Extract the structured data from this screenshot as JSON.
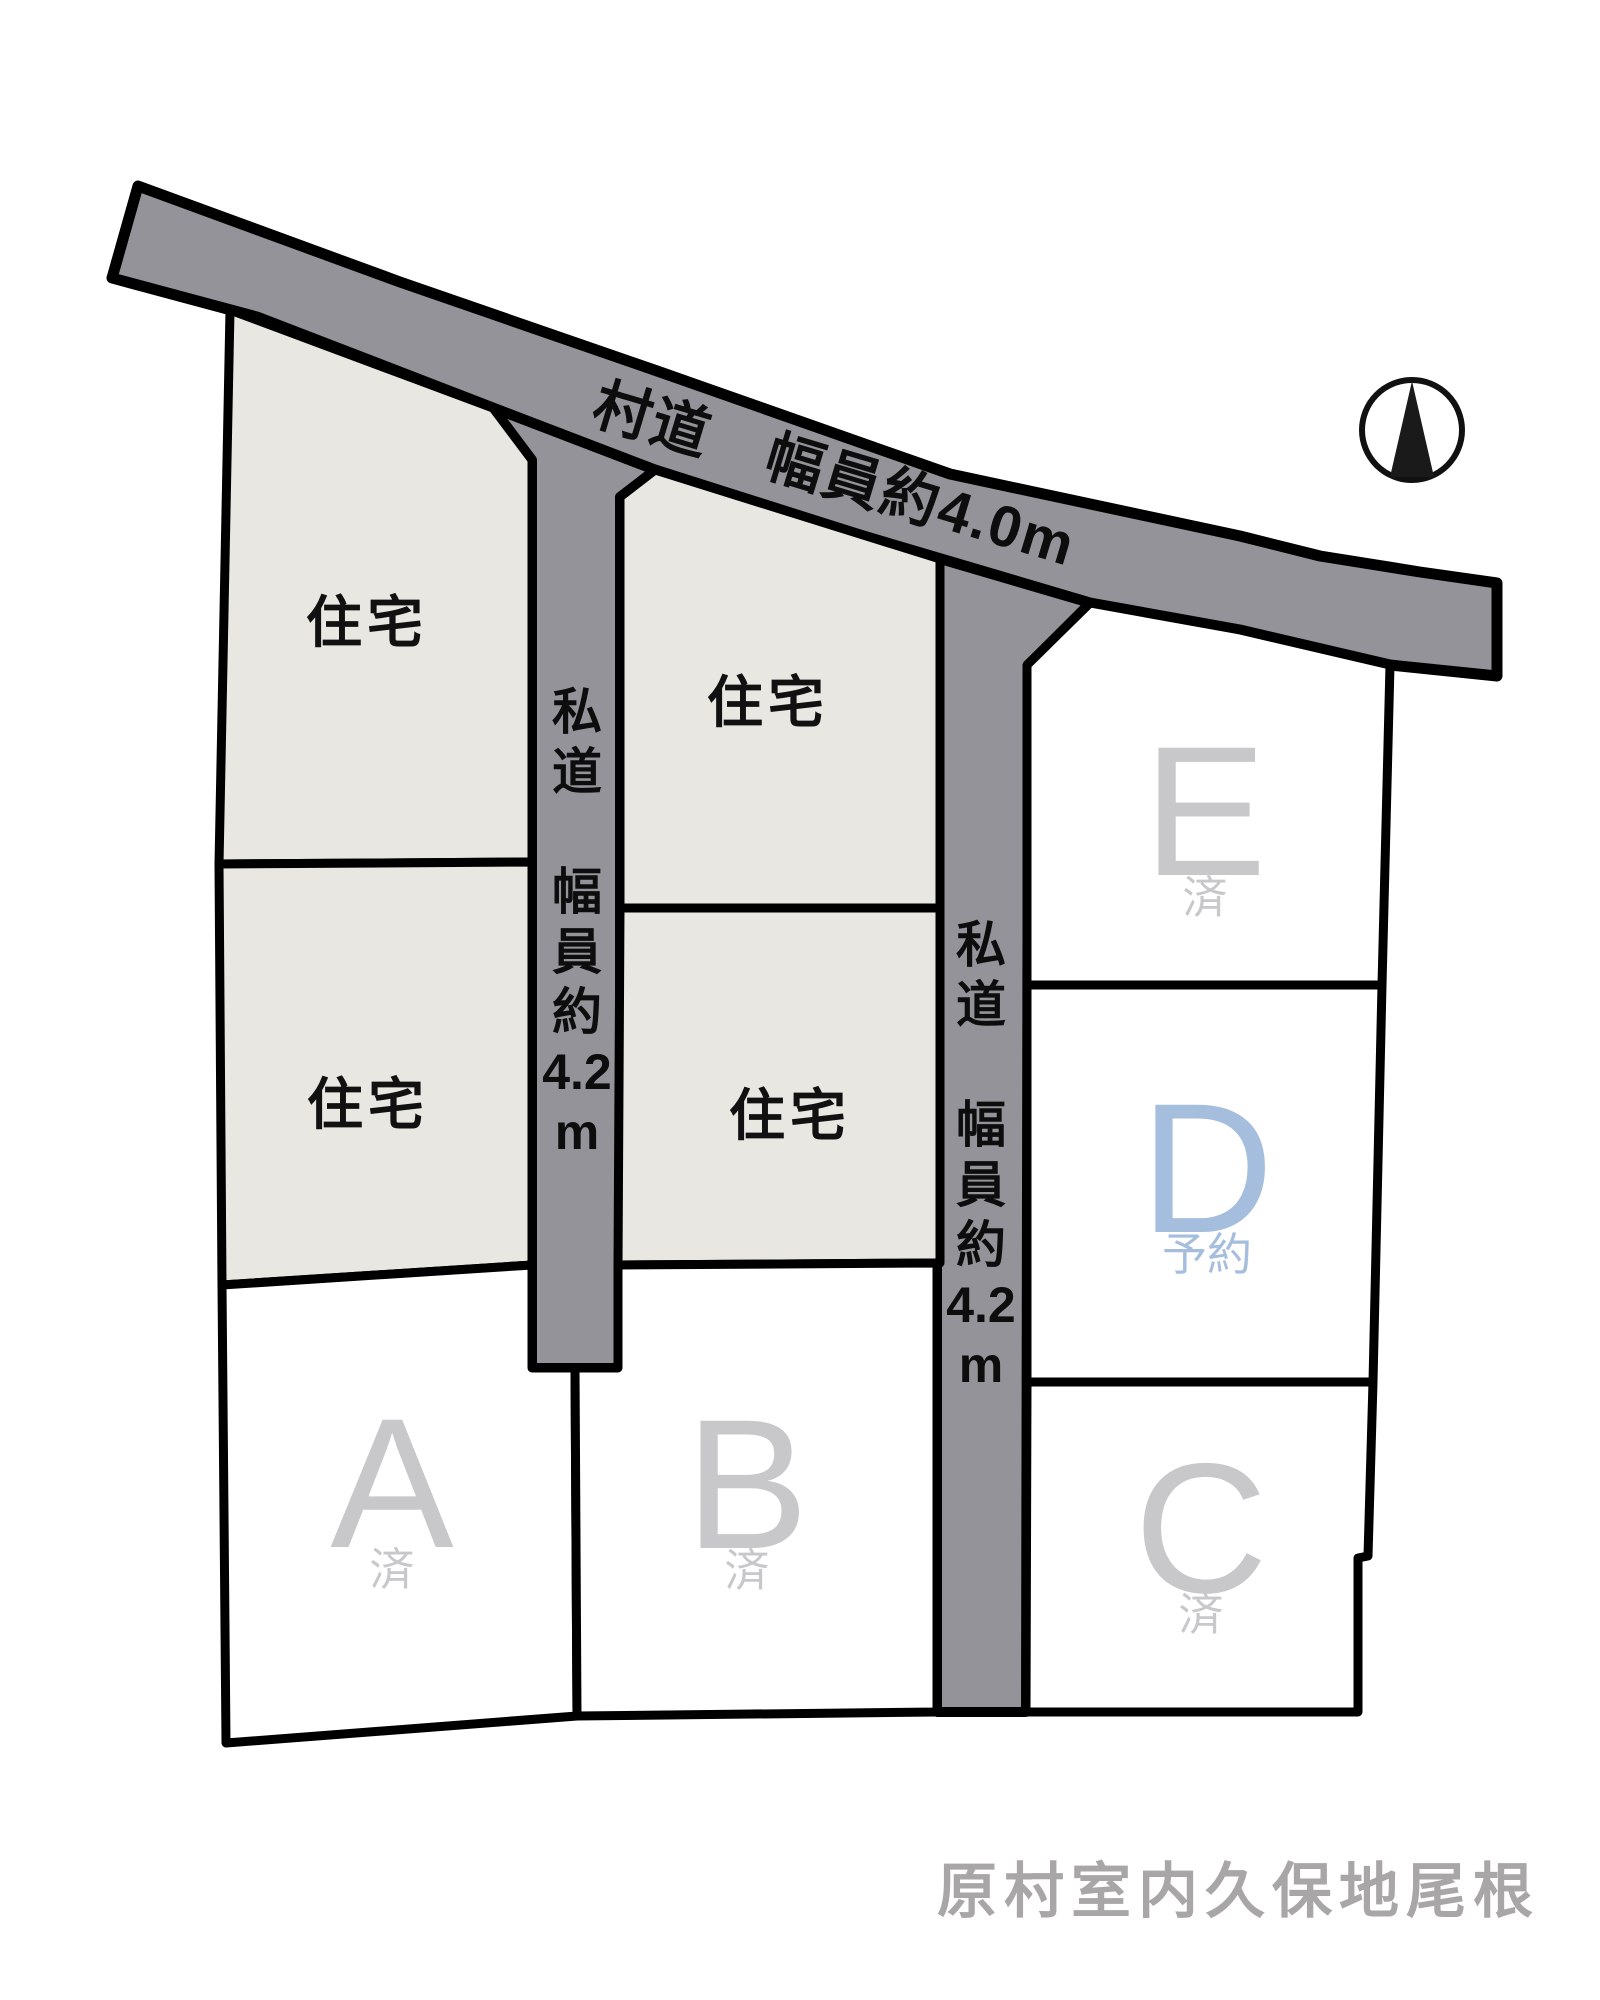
{
  "page": {
    "footer_location": "原村室内久保地尾根"
  },
  "colors": {
    "road_fill": "#949399",
    "residential_fill": "#e9e7e1",
    "plot_fill": "#ffffff",
    "outline": "#000000",
    "sold_text": "#c8c8ca",
    "reserved_text": "#a6bedd",
    "road_text": "#0d0d0d",
    "footer_text": "#a8a6a6"
  },
  "icons": {
    "compass": "north-arrow-icon"
  },
  "roads": {
    "village_road": {
      "label": "村道　幅員約4.0m"
    },
    "private_road_left": {
      "label": "私\n道\n\n幅\n員\n約\n4.2\nm"
    },
    "private_road_right": {
      "label": "私\n道\n\n幅\n員\n約\n4.2\nm"
    }
  },
  "residential_lots": [
    {
      "label": "住宅"
    },
    {
      "label": "住宅"
    },
    {
      "label": "住宅"
    },
    {
      "label": "住宅"
    }
  ],
  "plots": [
    {
      "id": "A",
      "status": "済"
    },
    {
      "id": "B",
      "status": "済"
    },
    {
      "id": "C",
      "status": "済"
    },
    {
      "id": "D",
      "status": "予約"
    },
    {
      "id": "E",
      "status": "済"
    }
  ]
}
